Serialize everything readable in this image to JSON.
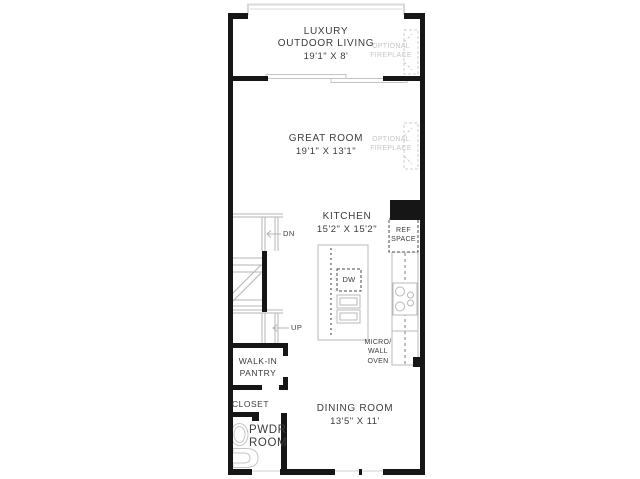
{
  "plan_title": "Floor plan",
  "colors": {
    "wall": "#161616",
    "counter_line": "#b8b8b8",
    "light_line": "#d6d6d6",
    "text": "#3c3c3c",
    "muted_text": "#c6c6c6"
  },
  "rooms": {
    "outdoor_living": {
      "line1": "LUXURY",
      "line2": "OUTDOOR LIVING",
      "dims": "19'1\" X 8'"
    },
    "great_room": {
      "name": "GREAT ROOM",
      "dims": "19'1\" X 13'1\""
    },
    "kitchen": {
      "name": "KITCHEN",
      "dims": "15'2\" X 15'2\""
    },
    "dining_room": {
      "name": "DINING ROOM",
      "dims": "13'5\" X 11'"
    },
    "walk_in_pantry": {
      "line1": "WALK-IN",
      "line2": "PANTRY"
    },
    "closet": {
      "name": "CLOSET"
    },
    "powder_room": {
      "line1": "PWDR",
      "line2": "ROOM"
    }
  },
  "features": {
    "optional_fireplace_upper": {
      "line1": "OPTIONAL",
      "line2": "FIREPLACE"
    },
    "optional_fireplace_lower": {
      "line1": "OPTIONAL",
      "line2": "FIREPLACE"
    },
    "ref_space": {
      "line1": "REF",
      "line2": "SPACE"
    },
    "micro_wall_oven": {
      "line1": "MICRO/",
      "line2": "WALL",
      "line3": "OVEN"
    },
    "dishwasher": {
      "label": "DW"
    },
    "stair_down": {
      "label": "DN"
    },
    "stair_up": {
      "label": "UP"
    }
  }
}
